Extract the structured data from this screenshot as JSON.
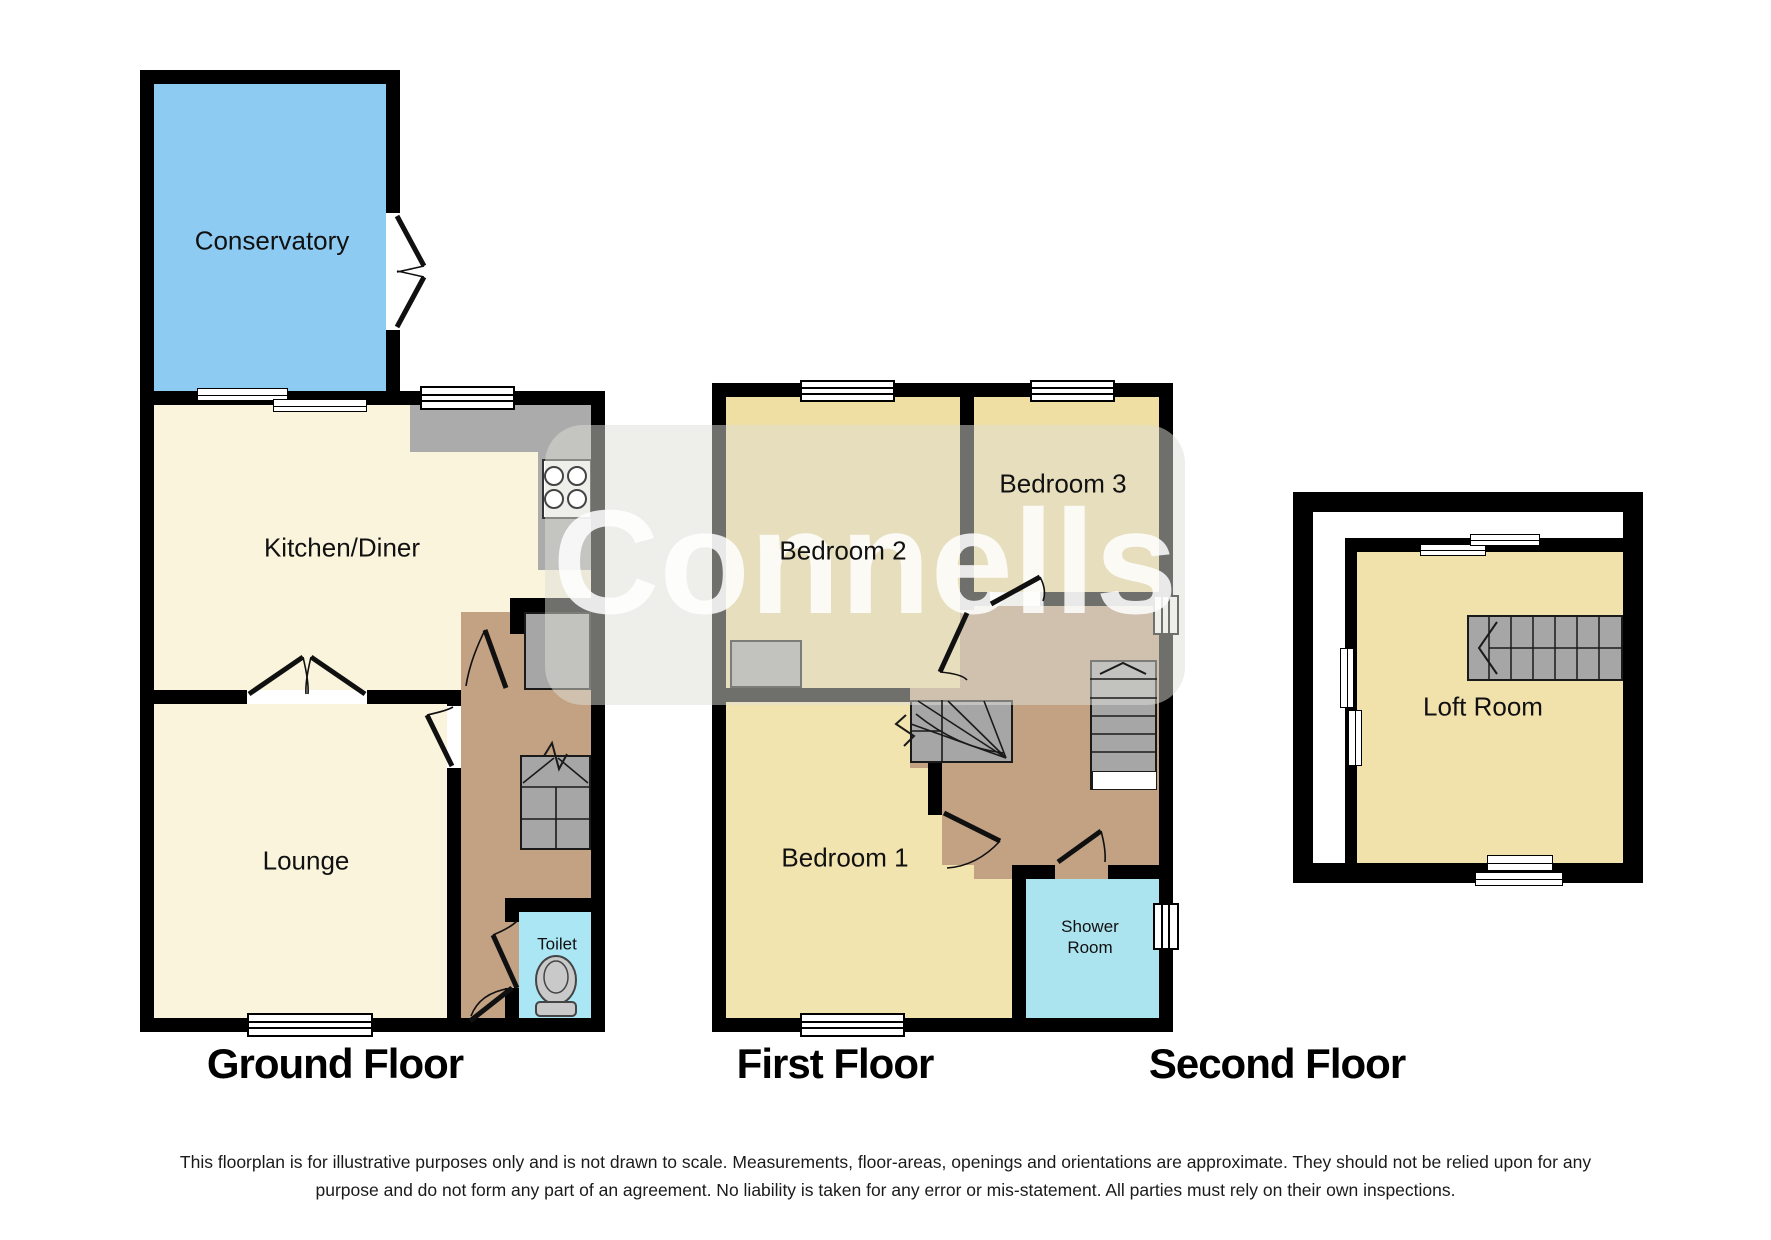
{
  "watermark": {
    "text": "Connells"
  },
  "floors": [
    {
      "title": "Ground Floor",
      "rooms": {
        "conservatory": "Conservatory",
        "kitchen": "Kitchen/Diner",
        "lounge": "Lounge",
        "toilet": "Toilet"
      }
    },
    {
      "title": "First Floor",
      "rooms": {
        "bedroom2": "Bedroom 2",
        "bedroom3": "Bedroom 3",
        "bedroom1": "Bedroom 1",
        "shower_line1": "Shower",
        "shower_line2": "Room"
      }
    },
    {
      "title": "Second Floor",
      "rooms": {
        "loft": "Loft Room"
      }
    }
  ],
  "disclaimer": {
    "line1": "This floorplan is for illustrative purposes only and is not drawn to scale. Measurements, floor-areas, openings and orientations are approximate. They should not be relied upon for any",
    "line2": "purpose and do not form any part of an agreement. No liability is taken for any error or mis-statement. All parties must rely on their own inspections."
  },
  "colors": {
    "wall": "#000000",
    "conservatory_fill": "#8ECBF2",
    "living_fill": "#FAF4DD",
    "bedroom_fill": "#EFDFA2",
    "loft_fill": "#F1E2AB",
    "hall_fill": "#C3A284",
    "toilet_fill": "#ABE6F5",
    "shower_fill": "#ABE3EF",
    "stairs_fill": "#A6A6A6",
    "counter_fill": "#ABABAB"
  }
}
